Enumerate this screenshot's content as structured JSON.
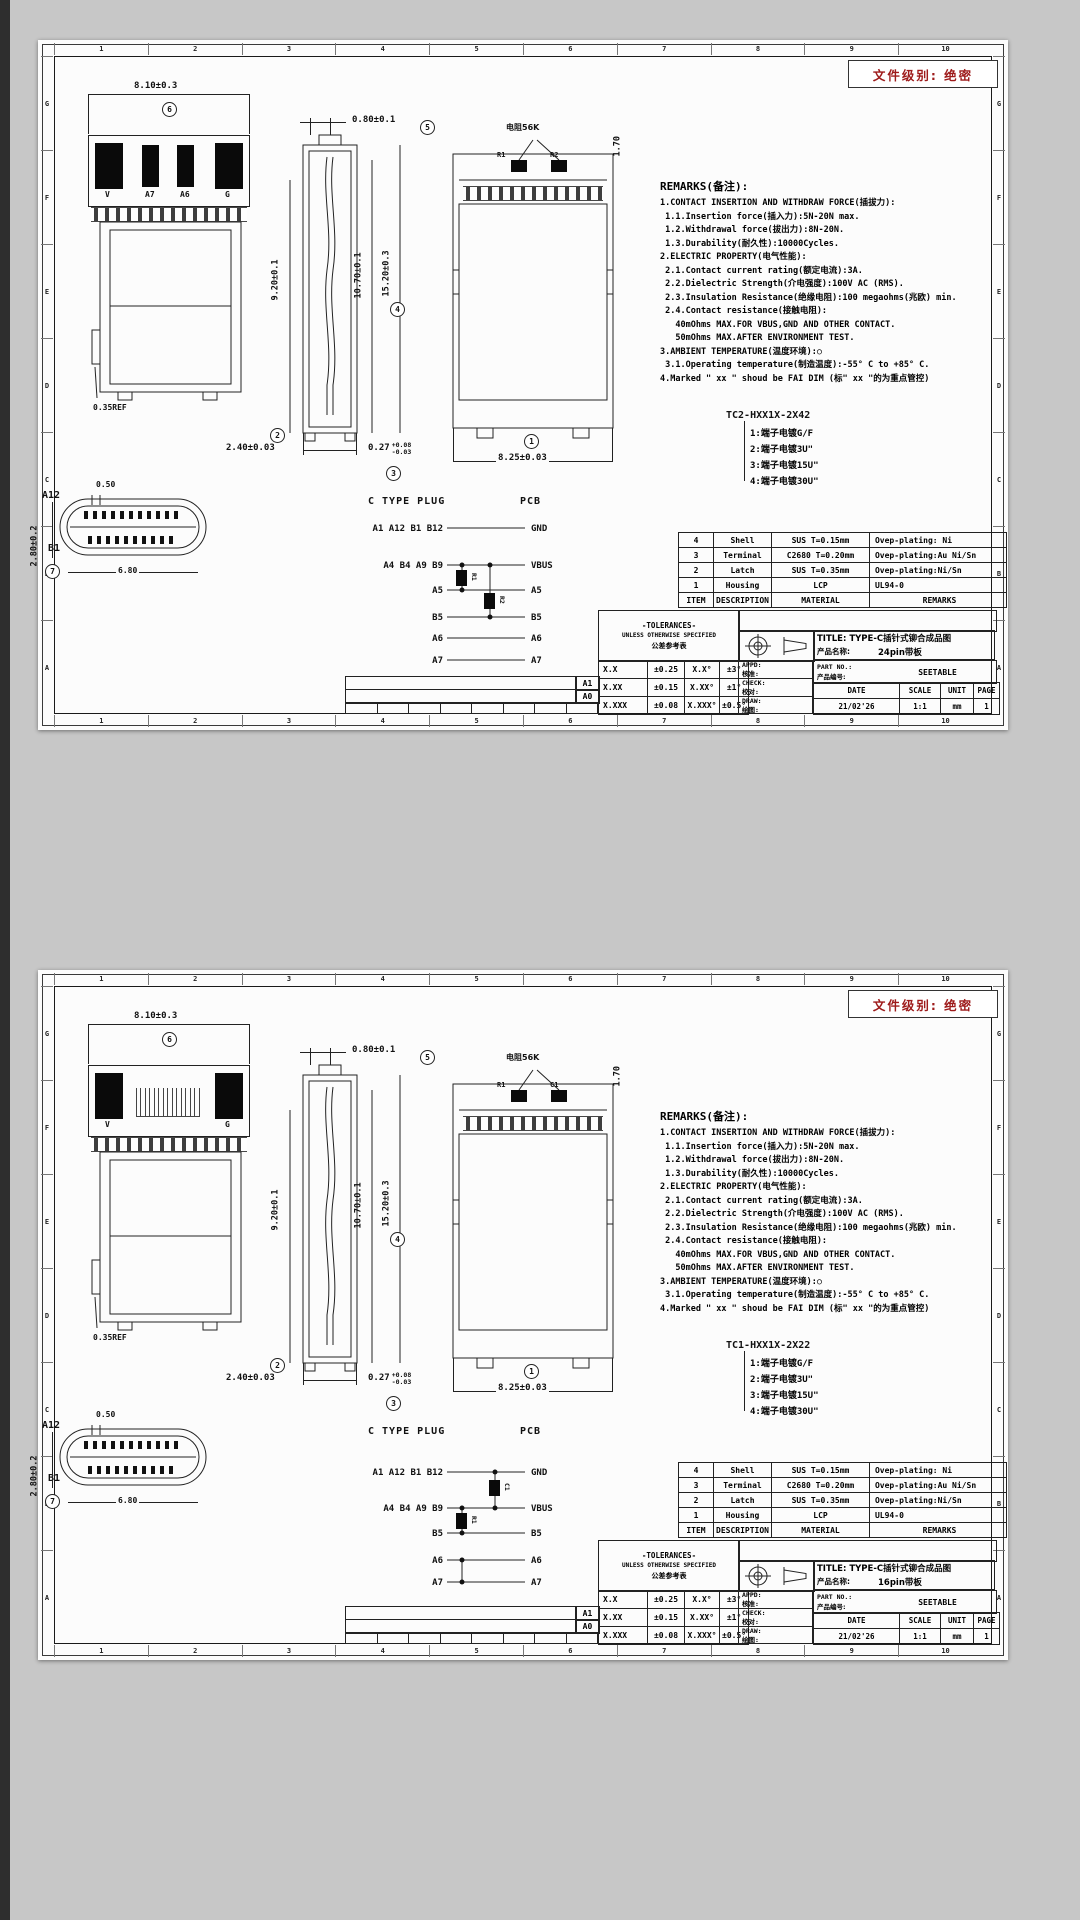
{
  "sheets": [
    {
      "variant": "v1",
      "classification": "文件级别: 绝密",
      "grid": {
        "cols": [
          "1",
          "2",
          "3",
          "4",
          "5",
          "6",
          "7",
          "8",
          "9",
          "10"
        ],
        "rows": [
          "G",
          "F",
          "E",
          "D",
          "C",
          "B",
          "A"
        ]
      },
      "plug_title": "C TYPE PLUG",
      "pcb_title": "PCB",
      "views": {
        "front": {
          "dim": "8.10±0.3",
          "balloon": "6",
          "pads": [
            "V",
            "A7",
            "A6",
            "G"
          ],
          "ref": "0.35REF"
        },
        "side": {
          "dim_top": "0.80±0.1",
          "balloon_top": "5",
          "dim_left": "9.20±0.1",
          "dim_mid": "10.70±0.1",
          "dim_right": "15.20±0.3",
          "balloon_right": "4",
          "dim_bottom1": "2.40±0.03",
          "balloon_bottom1": "2",
          "dim_bottom2": "0.27",
          "tol_up": "+0.08",
          "tol_dn": "-0.03",
          "balloon_bottom2": "3"
        },
        "pcb": {
          "res_label": "电阻56K",
          "chip1": "R1",
          "chip2": "R2",
          "dim_right": "1.70",
          "dim_bottom": "8.25±0.03",
          "balloon_bottom": "1"
        },
        "face": {
          "label_top": "A12",
          "label_bottom": "B1",
          "dim_top": "0.50",
          "dim_bottom": "6.80",
          "dim_left": "2.80±0.2",
          "balloon_left": "7"
        }
      },
      "circuit": {
        "rows": [
          {
            "l": "A1 A12 B1 B12",
            "r": "GND"
          },
          {
            "l": "A4 B4 A9 B9",
            "r": "VBUS"
          },
          {
            "l": "A5",
            "r": "A5"
          },
          {
            "l": "B5",
            "r": "B5"
          },
          {
            "l": "A6",
            "r": "A6"
          },
          {
            "l": "A7",
            "r": "A7"
          }
        ],
        "comp1": "R1",
        "comp2": "R2"
      },
      "remarks": {
        "title": "REMARKS(备注):",
        "lines": [
          "1.CONTACT INSERTION AND WITHDRAW FORCE(插拔力):",
          " 1.1.Insertion force(插入力):5N-20N max.",
          " 1.2.Withdrawal force(拔出力):8N-20N.",
          " 1.3.Durability(耐久性):10000Cycles.",
          "2.ELECTRIC PROPERTY(电气性能):",
          " 2.1.Contact current rating(额定电流):3A.",
          " 2.2.Dielectric Strength(介电强度):100V AC (RMS).",
          " 2.3.Insulation Resistance(绝缘电阻):100 megaohms(兆欧) min.",
          " 2.4.Contact resistance(接触电阻):",
          "   40mOhms MAX.FOR VBUS,GND AND OTHER CONTACT.",
          "   50mOhms MAX.AFTER ENVIRONMENT TEST.",
          "3.AMBIENT TEMPERATURE(温度环境):○",
          " 3.1.Operating temperature(制造温度):-55° C to +85° C.",
          "4.Marked \" xx \" shoud be FAI DIM (标\" xx \"的为重点管控)"
        ]
      },
      "part_code": "TC2-HXX1X-2X42",
      "plating_options": [
        "1:端子电镀G/F",
        "2:端子电镀3U\"",
        "3:端子电镀15U\"",
        "4:端子电镀30U\""
      ],
      "bom": {
        "rows": [
          [
            "4",
            "Shell",
            "SUS T=0.15mm",
            "Ovep-plating: Ni"
          ],
          [
            "3",
            "Terminal",
            "C2680 T=0.20mm",
            "Ovep-plating:Au Ni/Sn"
          ],
          [
            "2",
            "Latch",
            "SUS T=0.35mm",
            "Ovep-plating:Ni/Sn"
          ],
          [
            "1",
            "Housing",
            "LCP",
            "UL94-0"
          ]
        ],
        "header": [
          "ITEM",
          "DESCRIPTION",
          "MATERIAL",
          "REMARKS"
        ]
      },
      "tol": {
        "h1": "-TOLERANCES-",
        "h2": "UNLESS OTHERWISE SPECIFIED",
        "h3": "公差参考表",
        "rows": [
          [
            "X.X",
            "±0.25",
            "X.X°",
            "±3°"
          ],
          [
            "X.XX",
            "±0.15",
            "X.XX°",
            "±1°"
          ],
          [
            "X.XXX",
            "±0.08",
            "X.XXX°",
            "±0.5°"
          ]
        ],
        "sign": [
          {
            "en": "APPD:",
            "cn": "核准:"
          },
          {
            "en": "CHECK:",
            "cn": "校对:"
          },
          {
            "en": "DRAW:",
            "cn": "绘图:"
          }
        ]
      },
      "title_block": {
        "title": "TITLE: TYPE-C插针式铆合成品图",
        "name_label": "产品名称:",
        "name_value": "24pin带板",
        "part_label": "PART NO.:",
        "part_label2": "产品编号:",
        "part_value": "SEETABLE",
        "cols": [
          "DATE",
          "SCALE",
          "UNIT",
          "PAGE"
        ],
        "vals": [
          "21/02'26",
          "1:1",
          "mm",
          "1"
        ]
      },
      "rev": {
        "r1": "A1",
        "r2": "A0"
      }
    },
    {
      "variant": "v2",
      "classification": "文件级别: 绝密",
      "grid": {
        "cols": [
          "1",
          "2",
          "3",
          "4",
          "5",
          "6",
          "7",
          "8",
          "9",
          "10"
        ],
        "rows": [
          "G",
          "F",
          "E",
          "D",
          "C",
          "B",
          "A"
        ]
      },
      "plug_title": "C TYPE PLUG",
      "pcb_title": "PCB",
      "views": {
        "front": {
          "dim": "8.10±0.3",
          "balloon": "6",
          "pads": [
            "V",
            "",
            "",
            "G"
          ],
          "ref": "0.35REF"
        },
        "side": {
          "dim_top": "0.80±0.1",
          "balloon_top": "5",
          "dim_left": "9.20±0.1",
          "dim_mid": "10.70±0.1",
          "dim_right": "15.20±0.3",
          "balloon_right": "4",
          "dim_bottom1": "2.40±0.03",
          "balloon_bottom1": "2",
          "dim_bottom2": "0.27",
          "tol_up": "+0.08",
          "tol_dn": "-0.03",
          "balloon_bottom2": "3"
        },
        "pcb": {
          "res_label": "电阻56K",
          "chip1": "R1",
          "chip2": "C1",
          "dim_right": "1.70",
          "dim_bottom": "8.25±0.03",
          "balloon_bottom": "1"
        },
        "face": {
          "label_top": "A12",
          "label_bottom": "B1",
          "dim_top": "0.50",
          "dim_bottom": "6.80",
          "dim_left": "2.80±0.2",
          "balloon_left": "7"
        }
      },
      "circuit2": {
        "rows": [
          {
            "l": "A1 A12 B1 B12",
            "r": "GND"
          },
          {
            "l": "A4 B4 A9 B9",
            "r": "VBUS"
          },
          {
            "l": "B5",
            "r": "B5"
          },
          {
            "l": "A6",
            "r": "A6"
          },
          {
            "l": "A7",
            "r": "A7"
          }
        ],
        "comp1": "C1",
        "comp2": "R1"
      },
      "remarks": {
        "title": "REMARKS(备注):",
        "lines": [
          "1.CONTACT INSERTION AND WITHDRAW FORCE(插拔力):",
          " 1.1.Insertion force(插入力):5N-20N max.",
          " 1.2.Withdrawal force(拔出力):8N-20N.",
          " 1.3.Durability(耐久性):10000Cycles.",
          "2.ELECTRIC PROPERTY(电气性能):",
          " 2.1.Contact current rating(额定电流):3A.",
          " 2.2.Dielectric Strength(介电强度):100V AC (RMS).",
          " 2.3.Insulation Resistance(绝缘电阻):100 megaohms(兆欧) min.",
          " 2.4.Contact resistance(接触电阻):",
          "   40mOhms MAX.FOR VBUS,GND AND OTHER CONTACT.",
          "   50mOhms MAX.AFTER ENVIRONMENT TEST.",
          "3.AMBIENT TEMPERATURE(温度环境):○",
          " 3.1.Operating temperature(制造温度):-55° C to +85° C.",
          "4.Marked \" xx \" shoud be FAI DIM (标\" xx \"的为重点管控)"
        ]
      },
      "part_code": "TC1-HXX1X-2X22",
      "plating_options": [
        "1:端子电镀G/F",
        "2:端子电镀3U\"",
        "3:端子电镀15U\"",
        "4:端子电镀30U\""
      ],
      "bom": {
        "rows": [
          [
            "4",
            "Shell",
            "SUS T=0.15mm",
            "Ovep-plating: Ni"
          ],
          [
            "3",
            "Terminal",
            "C2680 T=0.20mm",
            "Ovep-plating:Au Ni/Sn"
          ],
          [
            "2",
            "Latch",
            "SUS T=0.35mm",
            "Ovep-plating:Ni/Sn"
          ],
          [
            "1",
            "Housing",
            "LCP",
            "UL94-0"
          ]
        ],
        "header": [
          "ITEM",
          "DESCRIPTION",
          "MATERIAL",
          "REMARKS"
        ]
      },
      "tol": {
        "h1": "-TOLERANCES-",
        "h2": "UNLESS OTHERWISE SPECIFIED",
        "h3": "公差参考表",
        "rows": [
          [
            "X.X",
            "±0.25",
            "X.X°",
            "±3°"
          ],
          [
            "X.XX",
            "±0.15",
            "X.XX°",
            "±1°"
          ],
          [
            "X.XXX",
            "±0.08",
            "X.XXX°",
            "±0.5°"
          ]
        ],
        "sign": [
          {
            "en": "APPD:",
            "cn": "核准:"
          },
          {
            "en": "CHECK:",
            "cn": "校对:"
          },
          {
            "en": "DRAW:",
            "cn": "绘图:"
          }
        ]
      },
      "title_block": {
        "title": "TITLE: TYPE-C插针式铆合成品图",
        "name_label": "产品名称:",
        "name_value": "16pin带板",
        "part_label": "PART NO.:",
        "part_label2": "产品编号:",
        "part_value": "SEETABLE",
        "cols": [
          "DATE",
          "SCALE",
          "UNIT",
          "PAGE"
        ],
        "vals": [
          "21/02'26",
          "1:1",
          "mm",
          "1"
        ]
      },
      "rev": {
        "r1": "A1",
        "r2": "A0"
      }
    }
  ]
}
